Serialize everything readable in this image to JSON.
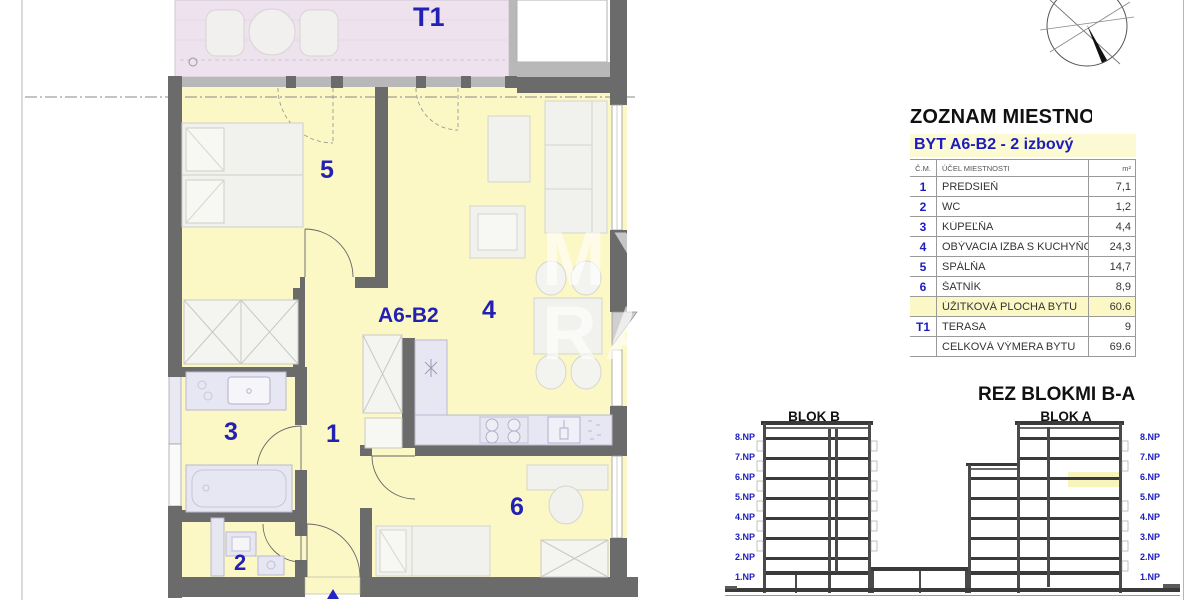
{
  "plan": {
    "unit_label": "A6-B2",
    "labels": {
      "terrace": "T1",
      "room1": "1",
      "room2": "2",
      "room3": "3",
      "room4": "4",
      "room5": "5",
      "room6": "6"
    },
    "watermark": {
      "line1": "MY",
      "line2": "RA"
    }
  },
  "room_list": {
    "title": "ZOZNAM MIESTNOS",
    "subtitle": "BYT A6-B2 - 2 izbový",
    "columns": {
      "num": "Č.M.",
      "name": "ÚČEL MIESTNOSTI",
      "area": "m²"
    },
    "rows": [
      {
        "num": "1",
        "name": "PREDSIEŇ",
        "area": "7,1",
        "highlight": false
      },
      {
        "num": "2",
        "name": "WC",
        "area": "1,2",
        "highlight": false
      },
      {
        "num": "3",
        "name": "KÚPEĽŇA",
        "area": "4,4",
        "highlight": false
      },
      {
        "num": "4",
        "name": "OBÝVACIA IZBA S KUCHYŇOU",
        "area": "24,3",
        "highlight": false
      },
      {
        "num": "5",
        "name": "SPÁLŇA",
        "area": "14,7",
        "highlight": false
      },
      {
        "num": "6",
        "name": "ŠATNÍK",
        "area": "8,9",
        "highlight": false
      },
      {
        "num": "",
        "name": "ÚŽITKOVÁ PLOCHA BYTU",
        "area": "60.6",
        "highlight": true
      },
      {
        "num": "T1",
        "name": "TERASA",
        "area": "9",
        "highlight": false
      },
      {
        "num": "",
        "name": "CELKOVÁ VÝMERA BYTU",
        "area": "69.6",
        "highlight": false
      }
    ]
  },
  "section": {
    "title": "REZ BLOKMI B-A",
    "block_b_label": "BLOK B",
    "block_a_label": "BLOK A",
    "floors": [
      "8.NP",
      "7.NP",
      "6.NP",
      "5.NP",
      "4.NP",
      "3.NP",
      "2.NP",
      "1.NP"
    ]
  },
  "colors": {
    "accent_blue": "#1c1cbe",
    "floor_yellow": "#fbf8c6",
    "terrace_pink": "#ede2ed",
    "fixture_lavender": "#e7e7f4",
    "wall_gray": "#6b6b6b",
    "highlight_yellow": "#f7f4bc"
  }
}
